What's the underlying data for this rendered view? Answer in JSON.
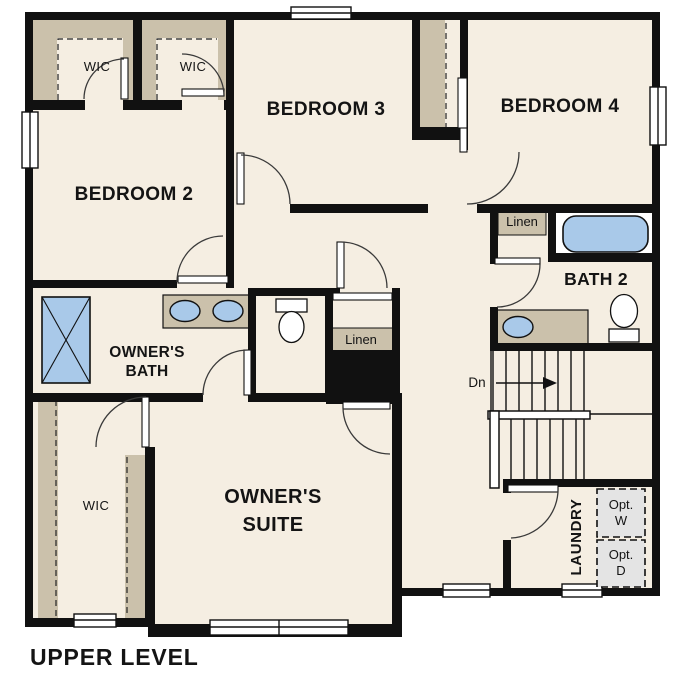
{
  "plan": {
    "title": "UPPER LEVEL",
    "level": "Upper Level floor plan"
  },
  "labels": {
    "bedroom2": "BEDROOM 2",
    "bedroom3": "BEDROOM 3",
    "bedroom4": "BEDROOM 4",
    "bath2": "BATH 2",
    "owners_bath_1": "OWNER'S",
    "owners_bath_2": "BATH",
    "owners_suite_1": "OWNER'S",
    "owners_suite_2": "SUITE",
    "wic": "WIC",
    "linen": "Linen",
    "laundry": "LAUNDRY",
    "opt_w_1": "Opt.",
    "opt_w_2": "W",
    "opt_d_1": "Opt.",
    "opt_d_2": "D",
    "dn": "Dn",
    "title": "UPPER LEVEL"
  },
  "colors": {
    "floor": "#f5eee2",
    "closet_shelf": "#cbc1ab",
    "wall": "#111111",
    "fixture_blue": "#a9c9e9",
    "appliance_gray": "#e4e4e4",
    "door_line": "#3a3a3a"
  }
}
